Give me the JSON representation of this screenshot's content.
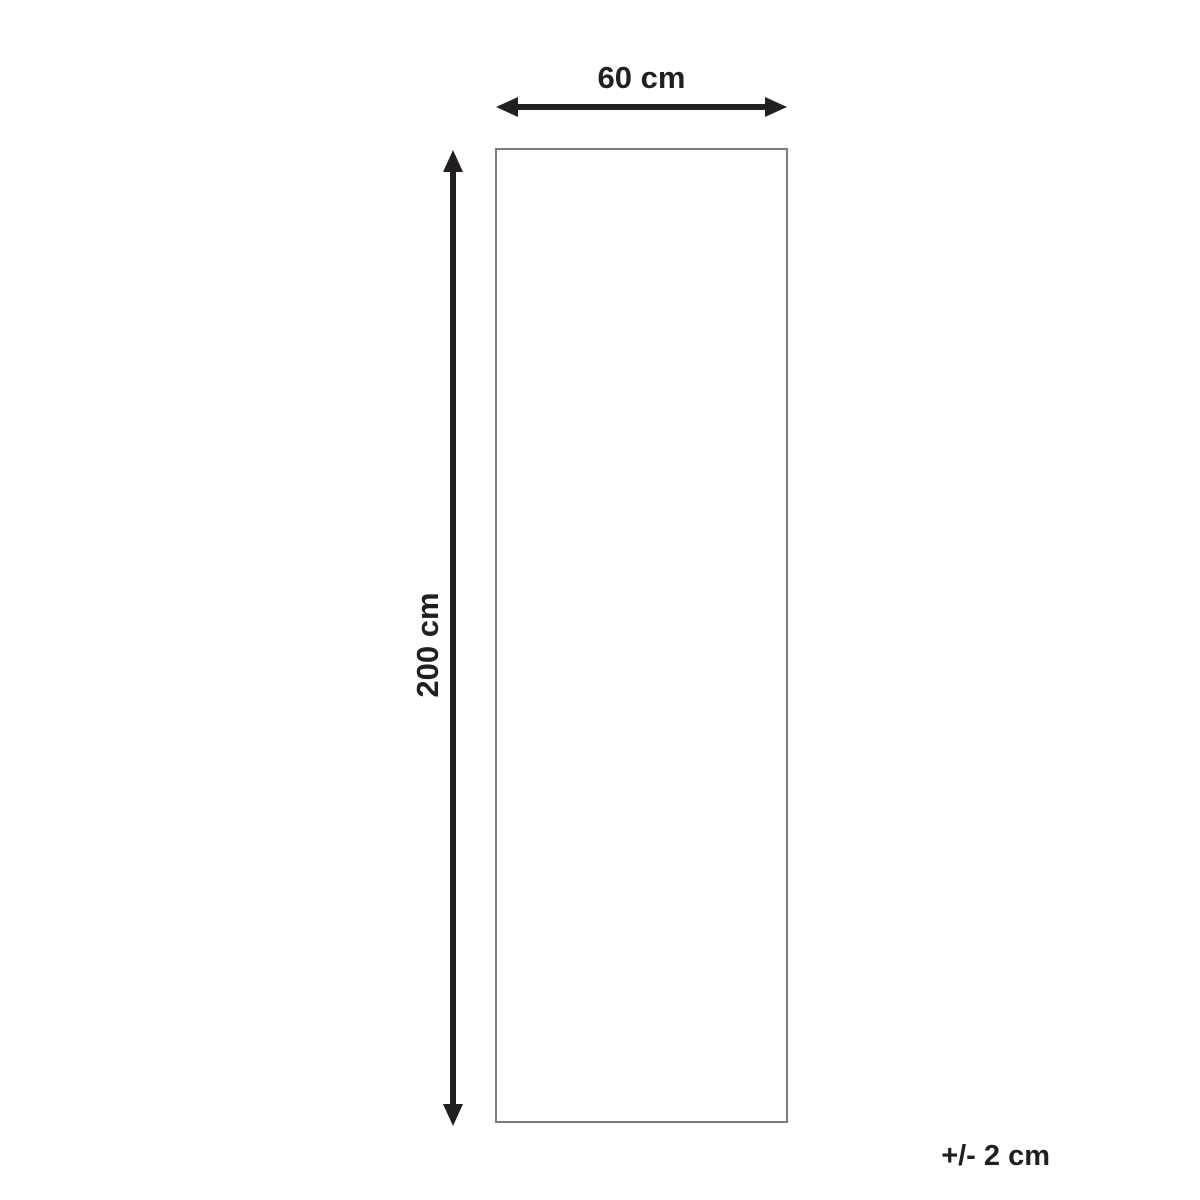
{
  "diagram": {
    "width_label": "60 cm",
    "height_label": "200 cm",
    "tolerance_label": "+/- 2 cm",
    "colors": {
      "arrow": "#231f20",
      "text": "#231f20",
      "rectangle_border": "#7b7b7b",
      "background": "#ffffff"
    }
  }
}
